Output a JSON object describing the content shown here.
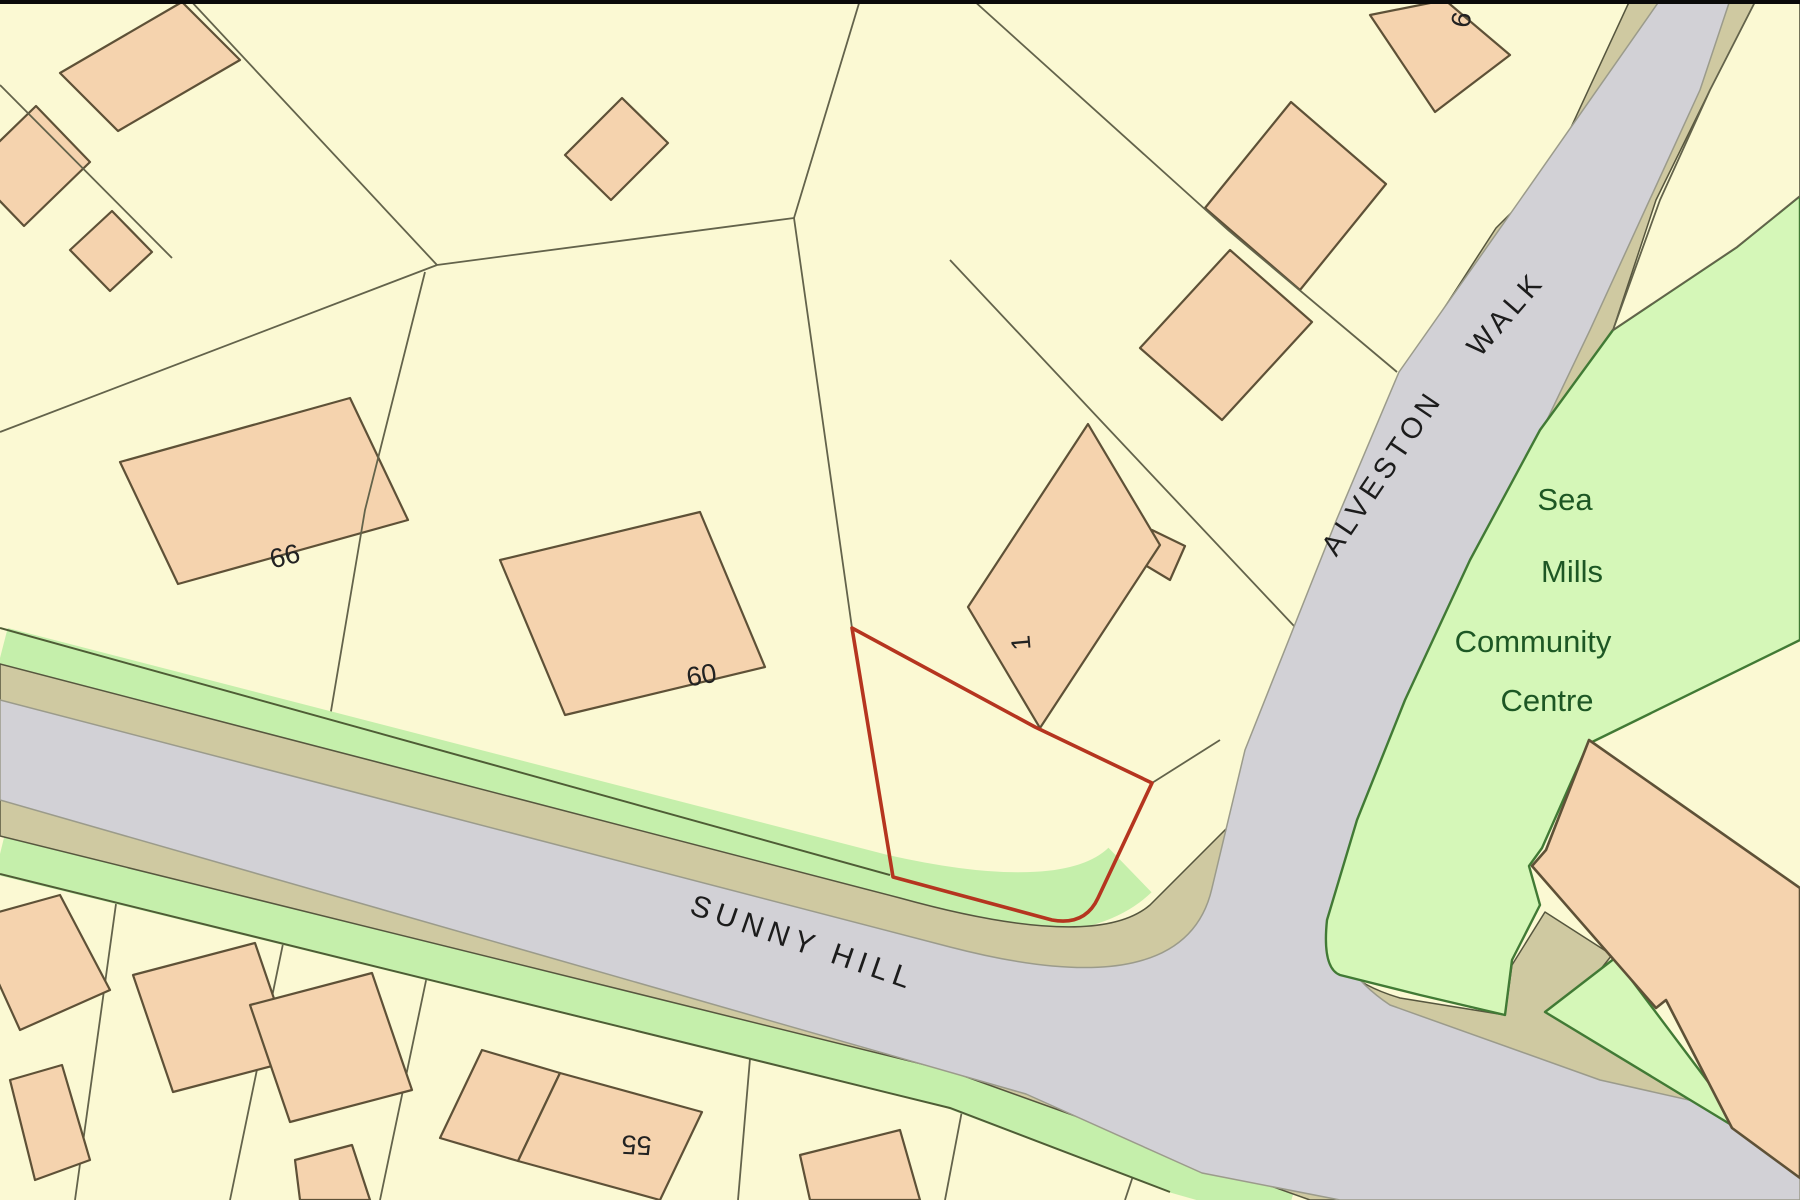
{
  "map": {
    "roads": {
      "sunny_hill": "SUNNY HILL",
      "alveston": "ALVESTON",
      "walk": "WALK"
    },
    "community_centre": {
      "line1": "Sea",
      "line2": "Mills",
      "line3": "Community",
      "line4": "Centre"
    },
    "house_numbers": {
      "n66": "66",
      "n60": "60",
      "n1": "1",
      "n55": "55",
      "n9": "9"
    },
    "palette": {
      "parcel_yellow": "#fbf9d3",
      "building_peach": "#f5d3ae",
      "building_outline": "#5e5137",
      "parcel_line": "#63634b",
      "road_gray": "#d2d1d6",
      "road_edge_tan": "#cfc9a1",
      "verge_green": "#c5efab",
      "community_green": "#d5f7b8",
      "community_outline": "#417a35",
      "community_text_green": "#1d5724",
      "site_boundary_red": "#b5351f",
      "label_black": "#1c1c1c"
    }
  }
}
